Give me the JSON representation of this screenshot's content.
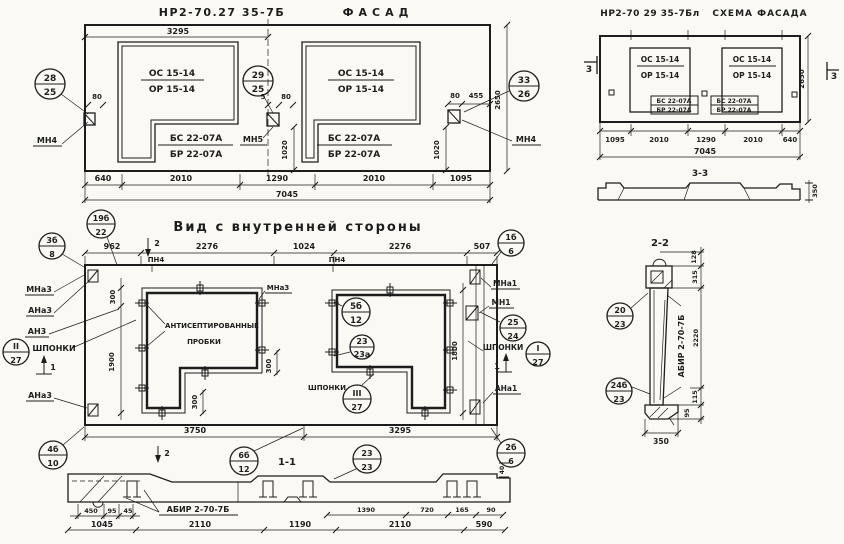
{
  "palette": {
    "paper": "#faf9f4",
    "ink": "#1d1d1d"
  },
  "facade": {
    "code": "НР2-70.27 35-7Б",
    "name": "ФАСАД",
    "dim_top": "3295",
    "win": {
      "os": "ОС 15-14",
      "op": "ОР 15-14",
      "bs": "БС 22-07А",
      "bp": "БР 22-07А"
    },
    "callouts": {
      "left": {
        "a": "28",
        "b": "25"
      },
      "mid": {
        "a": "29",
        "b": "25"
      },
      "right": {
        "a": "33",
        "b": "26"
      }
    },
    "anchors": {
      "left": "МН4",
      "mid": "МН5",
      "right": "МН4"
    },
    "d80": "80",
    "d5": "5",
    "d455": "455",
    "d1020": "1020",
    "height": "2650",
    "bottom": [
      "640",
      "2010",
      "1290",
      "2010",
      "1095"
    ],
    "total": "7045"
  },
  "schema": {
    "code": "НР2-70 29 35-7Бл",
    "name": "СХЕМА ФАСАДА",
    "win": {
      "os": "ОС 15-14",
      "op": "ОР 15-14",
      "bs": "БС 22-07А",
      "bp": "БР 22-07А"
    },
    "bottom": [
      "1095",
      "2010",
      "1290",
      "2010",
      "640"
    ],
    "total": "7045",
    "height": "2650",
    "mark": "3",
    "sec": "3-3",
    "thick": "350"
  },
  "inner": {
    "title": "Вид с внутренней стороны",
    "top": [
      "962",
      "2276",
      "1024",
      "2276",
      "507"
    ],
    "bottom": [
      "3750",
      "3295"
    ],
    "pn4": "ПН4",
    "mna3": "МНа3",
    "ana3": "АНа3",
    "an3": "АН3",
    "shp": "ШПОНКИ",
    "mna1": "МНа1",
    "mn1": "МН1",
    "ana1": "АНа1",
    "plug1": "АНТИСЕПТИРОВАННЫЕ",
    "plug2": "ПРОБКИ",
    "d300": "300",
    "d1900": "1900",
    "d1800": "1800",
    "m1": "1",
    "m2": "2",
    "sec": "1-1",
    "callouts": {
      "c3b8": {
        "a": "3б",
        "b": "8"
      },
      "c19b": {
        "a": "19б",
        "b": "22"
      },
      "c1b6": {
        "a": "1б",
        "b": "6"
      },
      "c5b": {
        "a": "5б",
        "b": "12"
      },
      "c23a": {
        "a": "23",
        "b": "23а"
      },
      "c2524": {
        "a": "25",
        "b": "24"
      },
      "cII": {
        "a": "II",
        "b": "27"
      },
      "cIII": {
        "a": "III",
        "b": "27"
      },
      "cI": {
        "a": "I",
        "b": "27"
      },
      "c4b": {
        "a": "4б",
        "b": "10"
      },
      "c6b": {
        "a": "6б",
        "b": "12"
      },
      "c2323": {
        "a": "23",
        "b": "23"
      },
      "c2b6": {
        "a": "2б",
        "b": "6"
      }
    }
  },
  "sec11": {
    "label": "АБИР 2-70-7Б",
    "row1": [
      "450",
      "95",
      "45"
    ],
    "row1r": [
      "1390",
      "720",
      "165",
      "90"
    ],
    "d40": "40",
    "row2": [
      "1045",
      "2110",
      "1190",
      "2110",
      "590"
    ]
  },
  "sec22": {
    "title": "2-2",
    "label": "АБИР 2-70-7Б",
    "d128": "128",
    "d315": "315",
    "d2220": "2220",
    "d115": "115",
    "d95": "95",
    "d350": "350",
    "callouts": {
      "top": {
        "a": "20",
        "b": "23"
      },
      "bot": {
        "a": "24б",
        "b": "23"
      }
    }
  }
}
